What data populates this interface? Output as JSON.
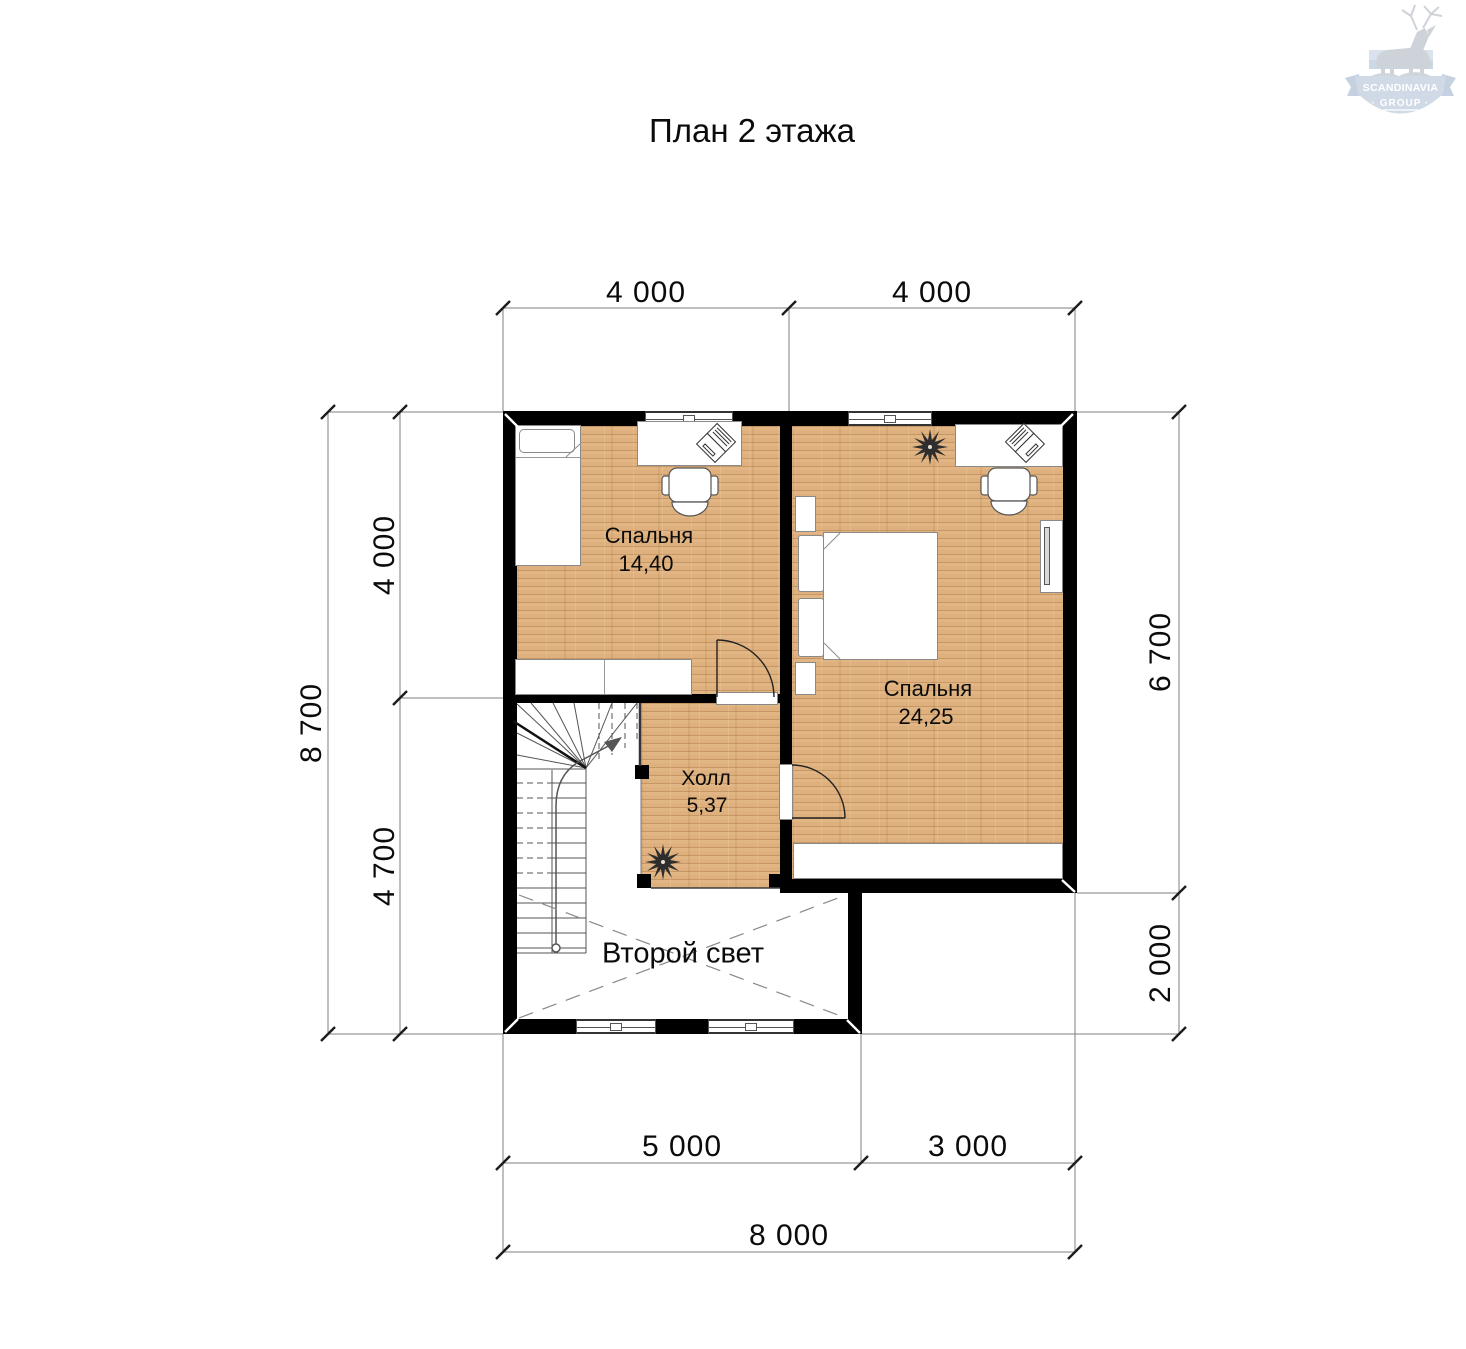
{
  "title": "План 2 этажа",
  "logo": {
    "line1": "SCANDINAVIA",
    "line2": "· GROUP ·"
  },
  "dimensions": {
    "top": [
      "4 000",
      "4 000"
    ],
    "left_outer": "8 700",
    "left_inner": [
      "4 000",
      "4 700"
    ],
    "right": [
      "6 700",
      "2 000"
    ],
    "bottom_inner": [
      "5 000",
      "3 000"
    ],
    "bottom_outer": "8 000"
  },
  "rooms": {
    "bedroom1": {
      "name": "Спальня",
      "area": "14,40"
    },
    "bedroom2": {
      "name": "Спальня",
      "area": "24,25"
    },
    "hall": {
      "name": "Холл",
      "area": "5,37"
    },
    "void": {
      "name": "Второй свет"
    }
  },
  "colors": {
    "wall": "#000000",
    "floor_wood": "#ddb07d",
    "dim_line": "#7f7f7f",
    "logo_blue": "#ccd7e4",
    "logo_gray": "#c9ced5"
  }
}
